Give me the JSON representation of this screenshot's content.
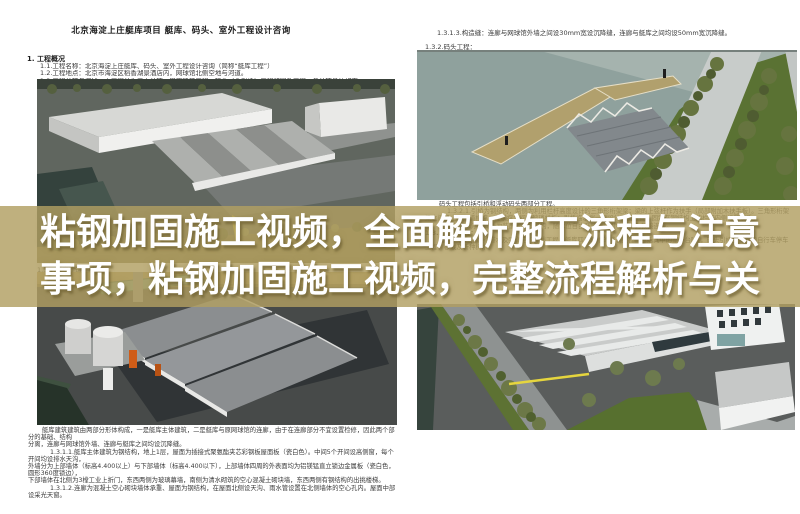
{
  "banner": {
    "line1": "粘钢加固施工视频，全面解析施工流程与注意",
    "line2": "事项，粘钢加固施工视频，完整流程解析与关",
    "band_color": "#b19f61",
    "text_color": "#ffffff"
  },
  "document": {
    "title": "北京海淀上庄艇库项目 艇库、码头、室外工程设计咨询",
    "section_heading": "1.  工程概况",
    "intro_lines": [
      "1.1.工程名称：北京海淀上庄艇库、码头、室外工程设计咨询（简称“艇库工程”）",
      "1.2.工程地点：北京市海淀区稻香湖景酒店内，网球馆北侧空地与河道。",
      "1.3.工程分项与概述：本工程分为三大分项：艇库建筑工程、码头（含引桥）工程和室外工程。各分项具体如下："
    ],
    "left_image_label": "1.3.1.艇库建筑工程：",
    "left_bottom_lines": [
      {
        "text": "艇库建筑建筑由两部分形体构成，一是艇库主体建筑，二是艇库与原网球馆的连廊，由于在连廊部分不宜设置检修，因此两个部分的基础、结构",
        "indent": "first"
      },
      {
        "text": "分离，连廊与网球馆外墙、连廊与艇库之间均设沉降缝。",
        "indent": "none"
      },
      {
        "text": "1.3.1.1.艇库主体建筑为钢结构，地上1层，屋面为插接式聚氨酯夹芯彩钢板屋面板（瓷白色）。中间5个开间设高侧窗，每个开间均设排水天沟，",
        "indent": "item"
      },
      {
        "text": "外墙分为上部墙体（标高4.400以上）与下部墙体（标高4.400以下），上部墙体四周的外表面均为铝镁锰直立锁边金属板（瓷白色，圆形360度锁边），",
        "indent": "none"
      },
      {
        "text": "下部墙体在北侧为3樘工业上折门，东西两侧为玻璃幕墙，南侧为清水砌筑的空心混凝土砌块墙，东西两侧有钢结构的出挑楼梯。",
        "indent": "none"
      },
      {
        "text": "1.3.1.2.连廊为混凝土空心砌块墙体承重、屋面为钢结构，在屋面北侧设天沟、雨水管设置在北侧墙体的空心孔内。屋面中部设采光天窗。",
        "indent": "item"
      }
    ],
    "right_top_lines": [
      "1.3.1.3.构造缝：连廊与网球馆外墙之间设30mm宽设沉降缝，连廊与艇库之间均设50mm宽沉降缝。",
      "1.3.2.码头工程："
    ],
    "right_mid": {
      "para1": "码头工程包括引桥和浮动码头两部分工程。",
      "para2": "1.3.2.1.引桥为钢结构，两侧为利用栏杆高度设计的三角形桁架梁；梁的上弦杆作为扶手（局部附加木扶手板）。三角形桁架梁之间设上下两道横撑，在横撑之间设玻璃栏板；引桥临水端一侧设计预留位置，固定在钢结构上的栏杆内侧设置扶手。",
      "para3": "1.3.2.2.浮动码头为装配式浮箱结构，随水位自由升降，与引桥之间为铰接连接。",
      "heading_133": "1.3.3.室外工程：",
      "para4": "室外工程包括：给排水及强弱电的外线工程，艇库四周场地的铺装工程（包括其中的室外台阶），码头引桥至道路的自行车停车工程，移栽及新种树木。"
    }
  },
  "renderings": {
    "top_left": {
      "name": "site-aerial-overview-rendering"
    },
    "top_right": {
      "name": "dock-and-truss-bridge-rendering"
    },
    "bottom_left": {
      "name": "boathouse-closeup-rendering"
    },
    "bottom_right": {
      "name": "site-aerial-parking-rendering"
    },
    "palette": {
      "water": "#36443d",
      "ground": "#5a5d5c",
      "roof_gray": "#8e9193",
      "building_white": "#efefed",
      "dock_tan": "#b1a06d",
      "grass": "#5a7233",
      "accent_orange": "#cf5c17",
      "marking_yellow": "#e5d53e"
    }
  }
}
